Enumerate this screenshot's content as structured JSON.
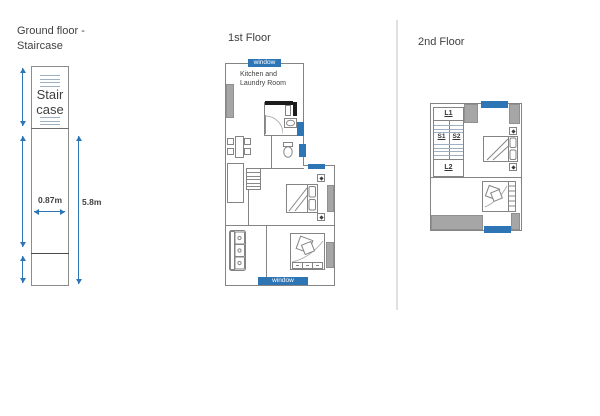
{
  "colors": {
    "accent_blue": "#2e75b6",
    "wall_gray": "#a6a6a6",
    "outline_gray": "#848484",
    "text_dark": "#3f3f3f",
    "background": "#ffffff"
  },
  "ground_floor": {
    "title": [
      "Ground floor -",
      "Staircase"
    ],
    "stair_label": [
      "Stair",
      "case"
    ],
    "width_dim": "0.87m",
    "height_dim": "5.8m"
  },
  "first_floor": {
    "title": "1st Floor",
    "window_top": "window",
    "window_bottom": "window",
    "kitchen_label": [
      "Kitchen and",
      "Laundry Room"
    ]
  },
  "second_floor": {
    "title": "2nd Floor",
    "landing_upper": "L1",
    "stair_left": "S1",
    "stair_right": "S2",
    "landing_lower": "L2"
  }
}
